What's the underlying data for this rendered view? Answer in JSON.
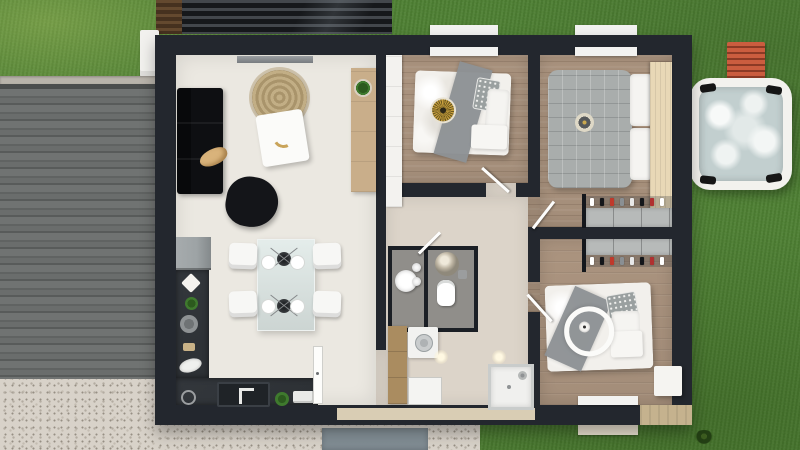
{
  "scene": {
    "type": "3d-floor-plan-top-view",
    "rooms": [
      {
        "id": "living-dining-kitchen",
        "furniture": [
          "wall-tv",
          "corner-sofa",
          "sleeping-dog",
          "round-jute-rug",
          "coffee-table",
          "beanbag-chair",
          "wood-sideboard",
          "potted-plant",
          "fridge",
          "l-shaped-kitchen-counter",
          "kitchen-sink",
          "toaster",
          "glass-dining-table",
          "two-pendant-lamps",
          "four-chairs",
          "four-plates",
          "tall-white-door"
        ]
      },
      {
        "id": "bedroom-1",
        "furniture": [
          "white-wardrobe",
          "double-bed",
          "gray-runner",
          "sun-cushion",
          "patterned-pillows",
          "window",
          "door"
        ]
      },
      {
        "id": "bedroom-2",
        "furniture": [
          "quilted-gray-bed",
          "white-pillows",
          "round-cushion",
          "wood-headboard",
          "wardrobe-with-clothes",
          "window",
          "door"
        ]
      },
      {
        "id": "bedroom-3",
        "furniture": [
          "double-bed",
          "ring-pendant-light",
          "patterned-pillow",
          "nightstand",
          "wardrobe-with-clothes",
          "window",
          "door"
        ]
      },
      {
        "id": "bathroom-wc",
        "furniture": [
          "round-washbasin",
          "toilet",
          "ball-pendant-lamp",
          "washing-machine",
          "linen-cabinet",
          "walk-in-shower",
          "front-door",
          "ceiling-spots"
        ]
      }
    ],
    "outdoor": [
      "lawn",
      "ribbed-driveway",
      "gravel-yard",
      "entry-path",
      "slatted-pergola",
      "white-planter",
      "hot-tub",
      "orange-sun-bench",
      "grass-tuft",
      "window-sills"
    ]
  },
  "wardrobes": {
    "clothes_colors": [
      "#ffffff",
      "#14161a",
      "#c0392b",
      "#8a8f93",
      "#e8e8e8",
      "#14161a",
      "#b03030",
      "#ffffff"
    ]
  },
  "colors": {
    "wall": "#23272e",
    "living_floor": "#ebe8e1",
    "wood_floor": "#a38d79",
    "hall_floor": "#dcd4c9",
    "wc_floor": "#908e8a",
    "grass": "#4e8033",
    "gravel": "#d8d2c9",
    "counter": "#2c3034",
    "sofa": "#0e0f12",
    "rug": "#c2ae85",
    "chair": "#f7f7f5",
    "duvet": "#f2f0ec",
    "runner": "#8e9295",
    "quilt": "#a9adac",
    "pillow_pattern": "#9aa0a0",
    "headboard": "#e8d8b6",
    "wardrobe_white": "#f3f2ef",
    "wardrobe_gray": "#b7bab9",
    "cabinet_wood": "#aa8c60",
    "appliance_white": "#f2f2f0",
    "tub_shell": "#f3f2ee",
    "tub_water": "#c2cfcf",
    "bench": "#c25036",
    "path": "#7e8a91",
    "deck": "#c5b28e",
    "door_leaf": "#fdfdfc",
    "fridge": "#9da3a5",
    "plant": "#3f7a2e",
    "dog": "#d9b37b",
    "beanbag": "#141519",
    "sideboard": "#c9ae8a"
  }
}
